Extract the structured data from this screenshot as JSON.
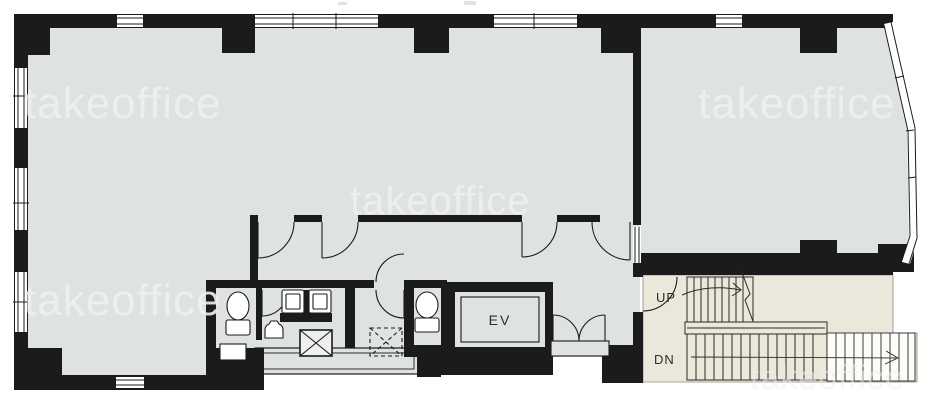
{
  "plan": {
    "elevator_label": "EV",
    "stairs": {
      "up_label": "UP",
      "down_label": "DN"
    },
    "watermark_text": "takeoffice",
    "colors": {
      "wall": "#1b1b1b",
      "floor": "#dfe3e0",
      "stair_floor": "#ece7db",
      "exterior": "#ffffff",
      "watermark": "#eef0ee",
      "line": "#1b1b1b"
    }
  }
}
